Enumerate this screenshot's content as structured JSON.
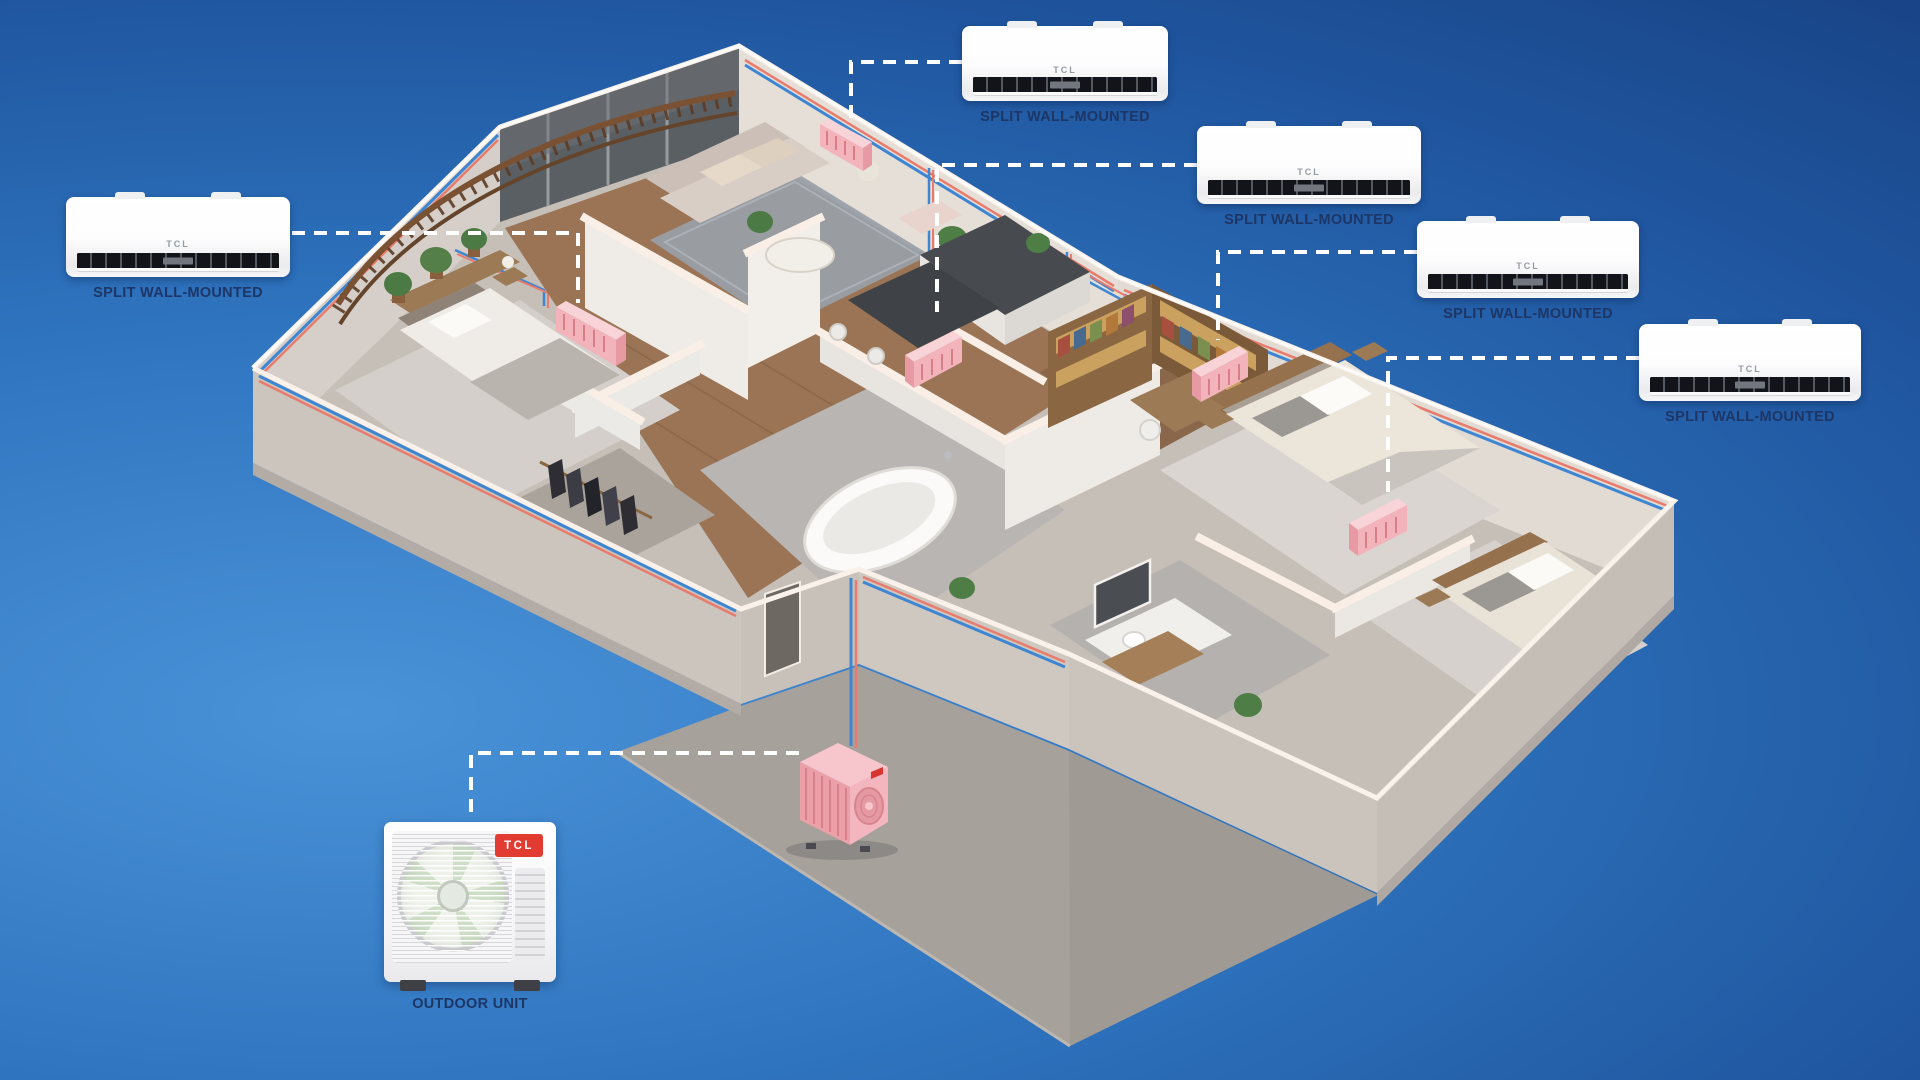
{
  "brand": "TCL",
  "indoor_units": [
    {
      "label": "SPLIT WALL-MOUNTED"
    },
    {
      "label": "SPLIT WALL-MOUNTED"
    },
    {
      "label": "SPLIT WALL-MOUNTED"
    },
    {
      "label": "SPLIT WALL-MOUNTED"
    },
    {
      "label": "SPLIT WALL-MOUNTED"
    }
  ],
  "outdoor_unit": {
    "label": "OUTDOOR UNIT",
    "badge": "TCL"
  },
  "colors": {
    "background_light": "#4a93d8",
    "background_dark": "#173f80",
    "label_text": "#1d3666",
    "tcl_red": "#e23b31",
    "pipe_cool": "#3f86d2",
    "pipe_warm": "#e87b6b",
    "indoor_unit_pink": "#f2b3bb",
    "wall_light": "#e6dfd8",
    "wall_shadow": "#c5beb7",
    "wood_floor": "#9a7454",
    "patio_concrete": "#a7a19b",
    "connector_dash": "#ffffff"
  }
}
